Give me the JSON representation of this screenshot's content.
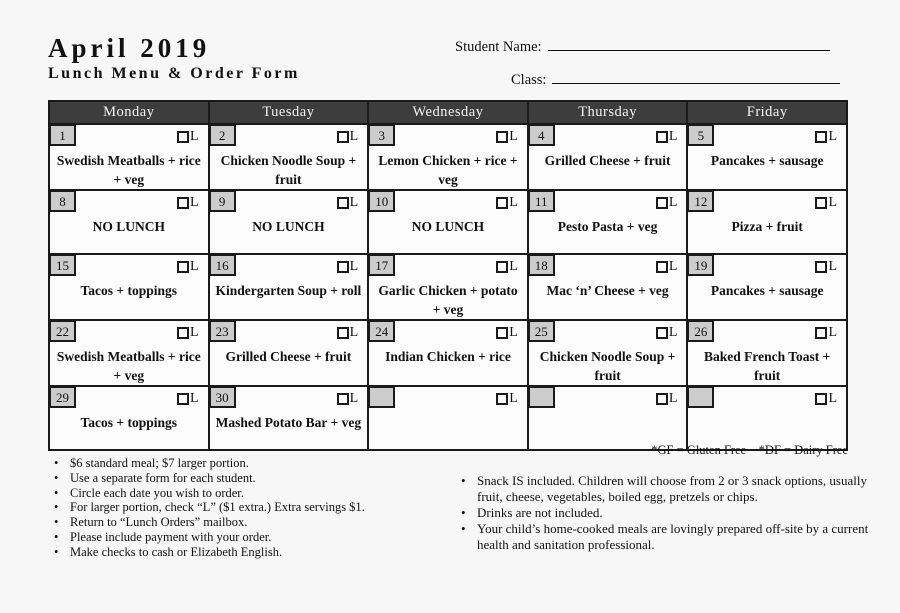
{
  "colors": {
    "page_bg": "#f7f7f7",
    "cell_bg": "#fcfcfc",
    "header_bg": "#3d3d3d",
    "header_text": "#f5f5f5",
    "date_box_bg": "#cccccc",
    "border": "#1a1a1a",
    "ink": "#111111"
  },
  "header": {
    "title": "April 2019",
    "subtitle": "Lunch Menu & Order Form",
    "student_name_label": "Student Name:",
    "student_name_value": "",
    "class_label": "Class:",
    "class_value": ""
  },
  "calendar": {
    "checkbox_label": "L",
    "days": [
      "Monday",
      "Tuesday",
      "Wednesday",
      "Thursday",
      "Friday"
    ],
    "weeks": [
      [
        {
          "date": "1",
          "menu": "Swedish Meatballs + rice + veg"
        },
        {
          "date": "2",
          "menu": "Chicken Noodle Soup + fruit"
        },
        {
          "date": "3",
          "menu": "Lemon Chicken + rice + veg"
        },
        {
          "date": "4",
          "menu": "Grilled Cheese + fruit"
        },
        {
          "date": "5",
          "menu": "Pancakes + sausage"
        }
      ],
      [
        {
          "date": "8",
          "menu": "NO LUNCH"
        },
        {
          "date": "9",
          "menu": "NO LUNCH"
        },
        {
          "date": "10",
          "menu": "NO LUNCH"
        },
        {
          "date": "11",
          "menu": "Pesto Pasta + veg"
        },
        {
          "date": "12",
          "menu": "Pizza + fruit"
        }
      ],
      [
        {
          "date": "15",
          "menu": "Tacos + toppings"
        },
        {
          "date": "16",
          "menu": "Kindergarten Soup + roll"
        },
        {
          "date": "17",
          "menu": "Garlic Chicken + potato + veg"
        },
        {
          "date": "18",
          "menu": "Mac ‘n’ Cheese + veg"
        },
        {
          "date": "19",
          "menu": "Pancakes + sausage"
        }
      ],
      [
        {
          "date": "22",
          "menu": "Swedish Meatballs + rice + veg"
        },
        {
          "date": "23",
          "menu": "Grilled Cheese + fruit"
        },
        {
          "date": "24",
          "menu": "Indian Chicken + rice"
        },
        {
          "date": "25",
          "menu": "Chicken Noodle Soup + fruit"
        },
        {
          "date": "26",
          "menu": "Baked French Toast + fruit"
        }
      ],
      [
        {
          "date": "29",
          "menu": "Tacos + toppings"
        },
        {
          "date": "30",
          "menu": "Mashed Potato Bar + veg"
        },
        {
          "date": "",
          "menu": ""
        },
        {
          "date": "",
          "menu": ""
        },
        {
          "date": "",
          "menu": ""
        }
      ]
    ]
  },
  "footnote": "*GF = Gluten Free    *DF = Dairy Free",
  "notes_left": [
    "$6 standard meal; $7 larger portion.",
    "Use a separate form for each student.",
    "Circle each date you wish to order.",
    "For larger portion, check “L” ($1 extra.) Extra servings $1.",
    "Return to “Lunch Orders” mailbox.",
    "Please include payment with your order.",
    "Make checks to cash or Elizabeth English."
  ],
  "notes_right": [
    "Snack IS included. Children will choose from 2 or 3 snack options, usually fruit, cheese, vegetables, boiled egg, pretzels or chips.",
    "Drinks are not included.",
    "Your child’s home-cooked meals are lovingly prepared off-site by a current health and sanitation professional."
  ]
}
